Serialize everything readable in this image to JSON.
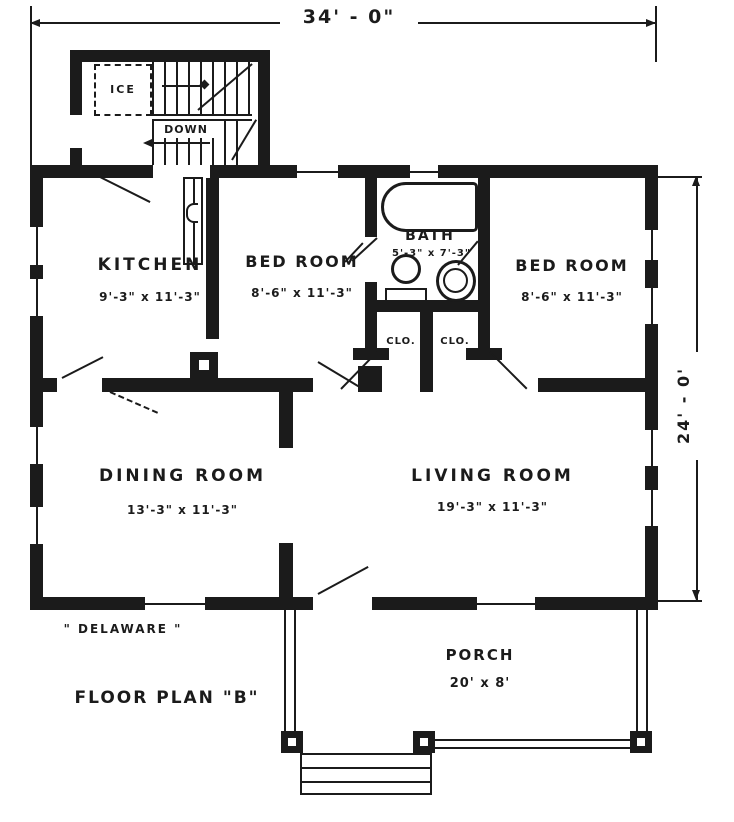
{
  "colors": {
    "ink": "#1b1b1b",
    "paper": "#ffffff"
  },
  "dimensions": {
    "overall_width": "34' - 0\"",
    "overall_height": "24' - 0'"
  },
  "rooms": {
    "kitchen": {
      "name": "KITCHEN",
      "size": "9'-3\" x 11'-3\""
    },
    "bedroom_left": {
      "name": "BED ROOM",
      "size": "8'-6\" x 11'-3\""
    },
    "bath": {
      "name": "BATH",
      "size": "5'-3\" x 7'-3\""
    },
    "bedroom_right": {
      "name": "BED ROOM",
      "size": "8'-6\" x 11'-3\""
    },
    "closet_left": {
      "name": "CLO."
    },
    "closet_right": {
      "name": "CLO."
    },
    "dining_room": {
      "name": "DINING ROOM",
      "size": "13'-3\" x 11'-3\""
    },
    "living_room": {
      "name": "LIVING ROOM",
      "size": "19'-3\" x 11'-3\""
    },
    "porch": {
      "name": "PORCH",
      "size": "20' x 8'"
    }
  },
  "annotations": {
    "ice_box": "ICE",
    "stair_direction": "DOWN",
    "house_name": "\" DELAWARE \"",
    "plan_title": "FLOOR PLAN \"B\""
  }
}
